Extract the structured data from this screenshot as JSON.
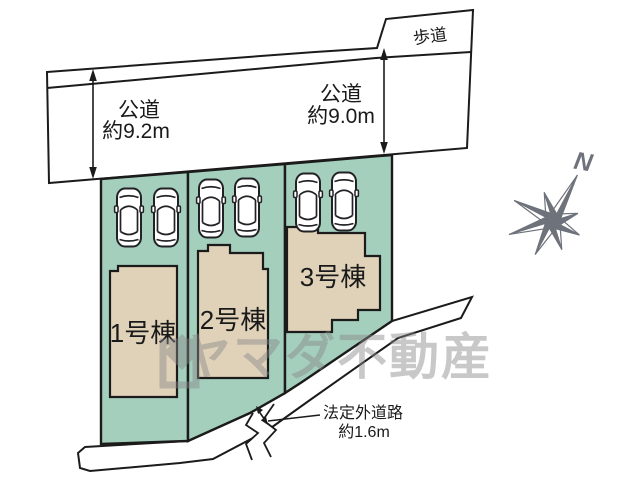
{
  "site_plan": {
    "public_road_top": {
      "sidewalk_label": "歩道",
      "width_left": {
        "line1": "公道",
        "line2": "約9.2m"
      },
      "width_right": {
        "line1": "公道",
        "line2": "約9.0m"
      }
    },
    "lots": [
      {
        "building_label": "1号棟"
      },
      {
        "building_label": "2号棟"
      },
      {
        "building_label": "3号棟"
      }
    ],
    "unofficial_road": {
      "line1": "法定外道路",
      "line2": "約1.6m"
    },
    "compass_label": "N",
    "watermark_text": "ヤマダ不動産"
  },
  "colors": {
    "road": "#c7c6c9",
    "lot": "#a5cfbd",
    "building": "#e0d2b8",
    "outline": "#1b1b1b",
    "compass": "#6e727b",
    "watermark": "#87878a"
  }
}
